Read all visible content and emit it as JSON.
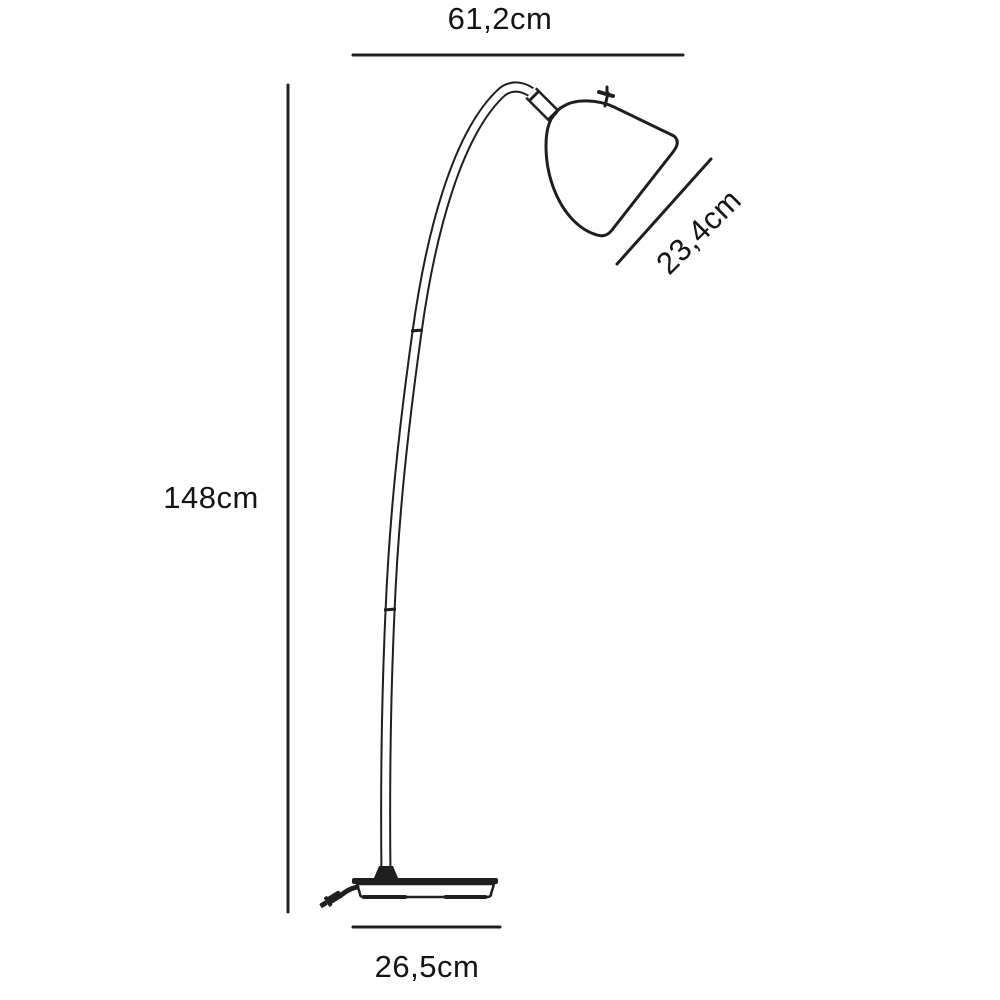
{
  "figure": {
    "type": "product-dimension-diagram",
    "subject": "arc floor lamp line drawing",
    "background_color": "#ffffff",
    "line_color": "#1f1f1f",
    "text_color": "#141414"
  },
  "dimensions": {
    "top_width_label": "61,2cm",
    "shade_diagonal_label": "23,4cm",
    "height_label": "148cm",
    "base_width_label": "26,5cm"
  }
}
